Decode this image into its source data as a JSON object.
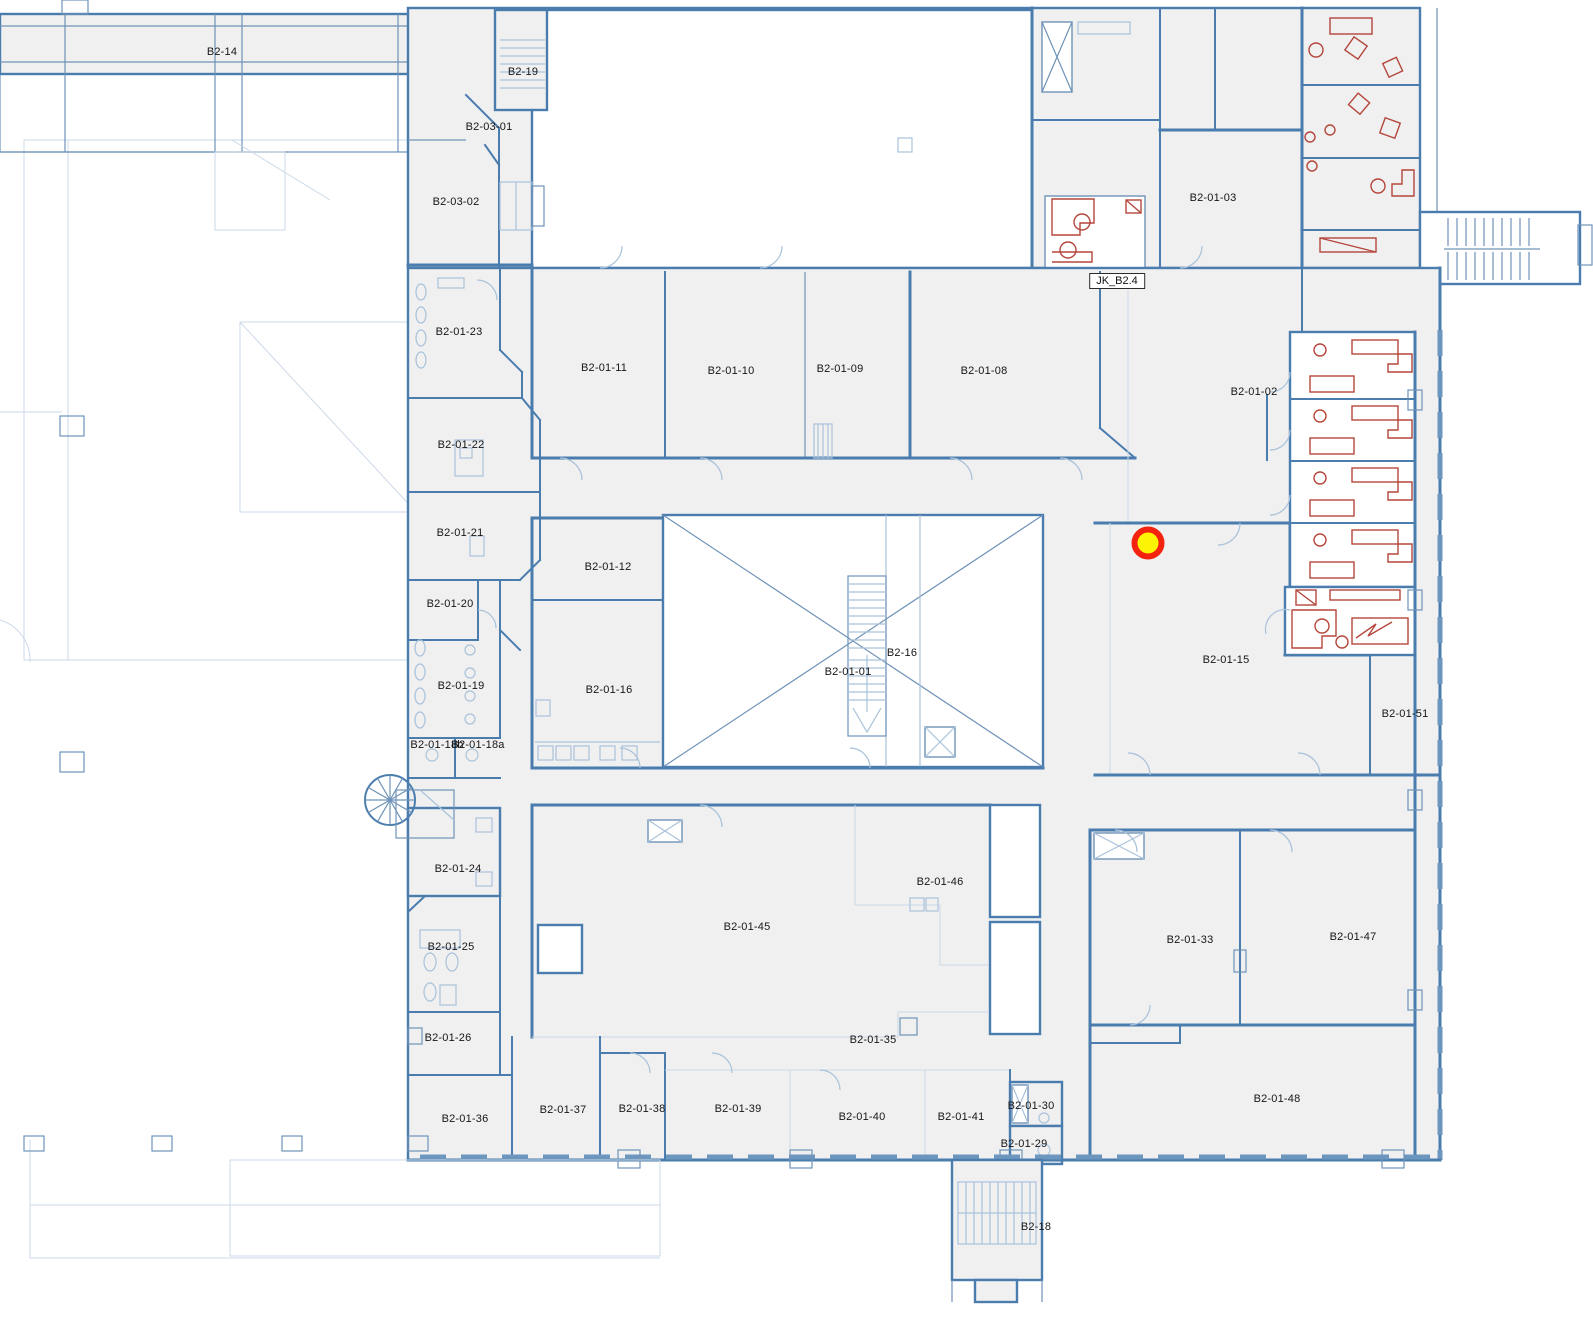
{
  "plan": {
    "level_name": "B2",
    "boxed_label": {
      "text": "JK_B2.4",
      "x": 1117,
      "y": 281
    }
  },
  "colors": {
    "wall": "#4a7dae",
    "wall_secondary": "#6f93b8",
    "light_detail": "#a9c2da",
    "faint_detail": "#ccd9e7",
    "room_fill": "#f0f0f1",
    "furniture_red": "#b5463c",
    "window": "#6d96bf",
    "marker_fill": "#fdf403",
    "marker_ring": "#f3230f"
  },
  "marker": {
    "x": 1148,
    "y": 543
  },
  "rooms": [
    {
      "label": "B2-14",
      "x": 222,
      "y": 52
    },
    {
      "label": "B2-19",
      "x": 523,
      "y": 72
    },
    {
      "label": "B2-03-01",
      "x": 489,
      "y": 127
    },
    {
      "label": "B2-03-02",
      "x": 456,
      "y": 202
    },
    {
      "label": "B2-01-03",
      "x": 1213,
      "y": 198
    },
    {
      "label": "B2-01-23",
      "x": 459,
      "y": 332
    },
    {
      "label": "B2-01-11",
      "x": 604,
      "y": 368
    },
    {
      "label": "B2-01-10",
      "x": 731,
      "y": 371
    },
    {
      "label": "B2-01-09",
      "x": 840,
      "y": 369
    },
    {
      "label": "B2-01-08",
      "x": 984,
      "y": 371
    },
    {
      "label": "B2-01-02",
      "x": 1254,
      "y": 392
    },
    {
      "label": "B2-01-22",
      "x": 461,
      "y": 445
    },
    {
      "label": "B2-01-21",
      "x": 460,
      "y": 533
    },
    {
      "label": "B2-01-12",
      "x": 608,
      "y": 567
    },
    {
      "label": "B2-01-20",
      "x": 450,
      "y": 604
    },
    {
      "label": "B2-16",
      "x": 902,
      "y": 653
    },
    {
      "label": "B2-01-15",
      "x": 1226,
      "y": 660
    },
    {
      "label": "B2-01-01",
      "x": 848,
      "y": 672
    },
    {
      "label": "B2-01-19",
      "x": 461,
      "y": 686
    },
    {
      "label": "B2-01-16",
      "x": 609,
      "y": 690
    },
    {
      "label": "B2-01-51",
      "x": 1405,
      "y": 714
    },
    {
      "label": "B2-01-18b",
      "x": 437,
      "y": 745
    },
    {
      "label": "B2-01-18a",
      "x": 478,
      "y": 745
    },
    {
      "label": "B2-01-24",
      "x": 458,
      "y": 869
    },
    {
      "label": "B2-01-46",
      "x": 940,
      "y": 882
    },
    {
      "label": "B2-01-45",
      "x": 747,
      "y": 927
    },
    {
      "label": "B2-01-33",
      "x": 1190,
      "y": 940
    },
    {
      "label": "B2-01-47",
      "x": 1353,
      "y": 937
    },
    {
      "label": "B2-01-25",
      "x": 451,
      "y": 947
    },
    {
      "label": "B2-01-26",
      "x": 448,
      "y": 1038
    },
    {
      "label": "B2-01-35",
      "x": 873,
      "y": 1040
    },
    {
      "label": "B2-01-48",
      "x": 1277,
      "y": 1099
    },
    {
      "label": "B2-01-30",
      "x": 1031,
      "y": 1106
    },
    {
      "label": "B2-01-37",
      "x": 563,
      "y": 1110
    },
    {
      "label": "B2-01-38",
      "x": 642,
      "y": 1109
    },
    {
      "label": "B2-01-39",
      "x": 738,
      "y": 1109
    },
    {
      "label": "B2-01-40",
      "x": 862,
      "y": 1117
    },
    {
      "label": "B2-01-41",
      "x": 961,
      "y": 1117
    },
    {
      "label": "B2-01-36",
      "x": 465,
      "y": 1119
    },
    {
      "label": "B2-01-29",
      "x": 1024,
      "y": 1144
    },
    {
      "label": "B2-18",
      "x": 1036,
      "y": 1227
    }
  ]
}
